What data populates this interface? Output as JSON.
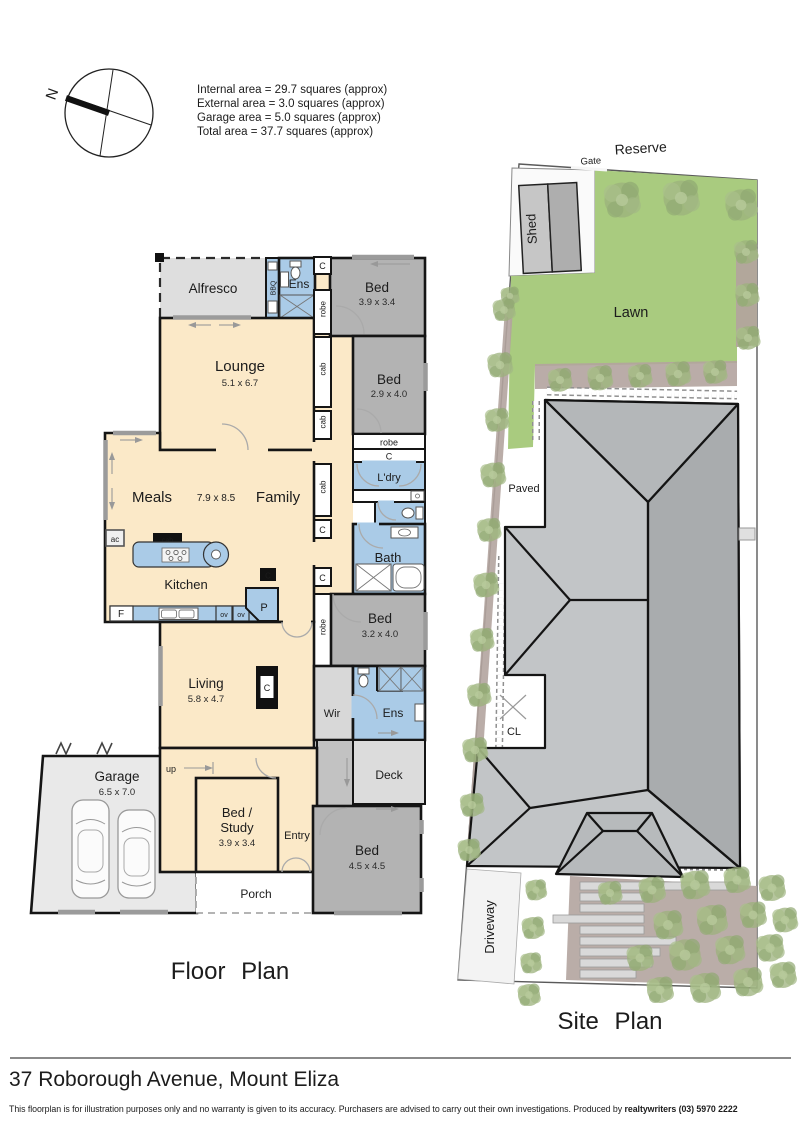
{
  "compass": {
    "north_label": "N"
  },
  "area_summary": {
    "lines": [
      "Internal area = 29.7 squares (approx)",
      "External area = 3.0 squares (approx)",
      "Garage area = 5.0 squares (approx)",
      "Total area = 37.7 squares (approx)"
    ]
  },
  "floor_plan": {
    "title": "Floor Plan",
    "rooms": {
      "alfresco": {
        "name": "Alfresco"
      },
      "ens_front": {
        "name": "Ens"
      },
      "bed_front": {
        "name": "Bed",
        "dims": "3.9 x 3.4"
      },
      "lounge": {
        "name": "Lounge",
        "dims": "5.1 x 6.7"
      },
      "bed_mid": {
        "name": "Bed",
        "dims": "2.9 x 4.0"
      },
      "meals": {
        "name": "Meals"
      },
      "family": {
        "name": "Family"
      },
      "meals_family_dims": "7.9 x 8.5",
      "laundry": {
        "name": "L'dry"
      },
      "bath": {
        "name": "Bath"
      },
      "kitchen": {
        "name": "Kitchen"
      },
      "bed_rear": {
        "name": "Bed",
        "dims": "3.2 x 4.0"
      },
      "living": {
        "name": "Living",
        "dims": "5.8 x 4.7"
      },
      "wir": {
        "name": "Wir"
      },
      "ens_rear": {
        "name": "Ens"
      },
      "deck": {
        "name": "Deck"
      },
      "garage": {
        "name": "Garage",
        "dims": "6.5 x 7.0"
      },
      "bed_study": {
        "name_line1": "Bed /",
        "name_line2": "Study",
        "dims": "3.9 x 3.4"
      },
      "entry": {
        "name": "Entry"
      },
      "porch": {
        "name": "Porch"
      },
      "bed_front_right": {
        "name": "Bed",
        "dims": "4.5 x 4.5"
      }
    },
    "labels": {
      "c": "C",
      "cab": "cab",
      "robe": "robe",
      "bbq": "BBQ",
      "ac": "ac",
      "up": "up",
      "f": "F",
      "p": "P",
      "ov": "ov"
    }
  },
  "site_plan": {
    "title": "Site Plan",
    "labels": {
      "reserve": "Reserve",
      "gate": "Gate",
      "shed": "Shed",
      "lawn": "Lawn",
      "paved": "Paved",
      "cl": "CL",
      "driveway": "Driveway"
    }
  },
  "footer": {
    "address": "37 Roborough Avenue, Mount Eliza",
    "disclaimer_prefix": "This floorplan is for illustration purposes only and no warranty is given to its accuracy. Purchasers are advised to carry out their own investigations. Produced by ",
    "producer": "realtywriters (03) 5970 2222"
  },
  "palette": {
    "floor_cream": "#fbe9c8",
    "wet_blue": "#aacbe7",
    "bed_grey": "#b3b3b3",
    "deck_grey": "#dcdcdc",
    "garage_grey": "#e9e9e9",
    "wall_black": "#151515",
    "lawn_green": "#a9cb7f",
    "mulch": "#b3a49f",
    "roof_light": "#c2c5c7",
    "roof_dark": "#a9acae"
  }
}
